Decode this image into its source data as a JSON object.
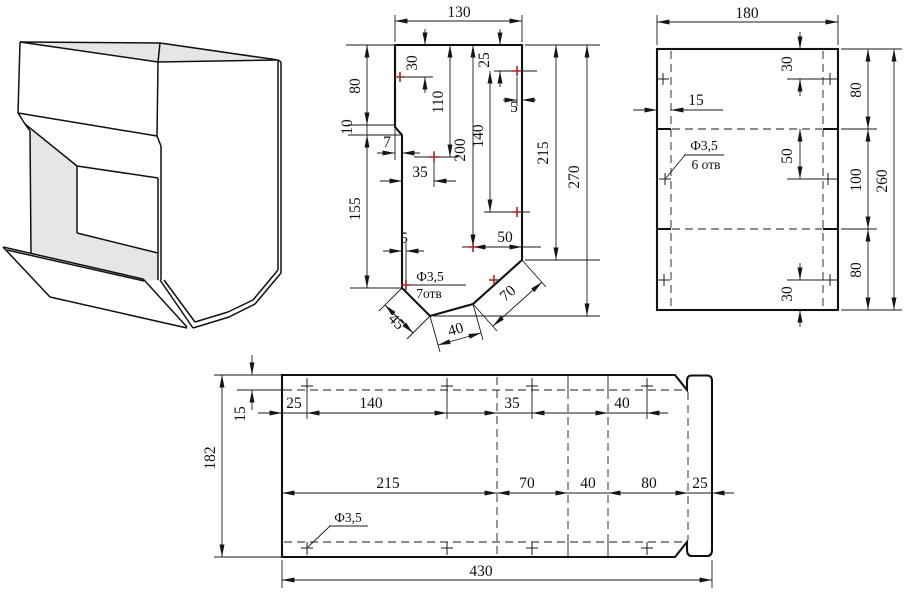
{
  "colors": {
    "line": "#1a1a1a",
    "hole_mark": "#a02424",
    "shade_fill": "#e6e6e6"
  },
  "flat_main": {
    "dims": {
      "overall_width": "130",
      "edge_top": "80",
      "edge_step": "10",
      "edge_lower": "155",
      "step_depth": "7",
      "hole_row1": "30",
      "hole_col": "110",
      "hole_deep": "200",
      "hole_span": "140",
      "hole_row2": "25",
      "edge_off_right": "5",
      "hole_left": "35",
      "edge_off_bottom": "5",
      "hole_bottom": "50",
      "height_right": "215",
      "height_overall": "270",
      "chamfer_left": "45",
      "chamfer_mid": "40",
      "chamfer_right": "70",
      "holes_dia": "Ф3,5",
      "holes_count": "7отв"
    }
  },
  "flat_side": {
    "dims": {
      "overall_width": "180",
      "holes_top": "30",
      "band_top": "80",
      "edge_offset": "15",
      "holes_mid": "50",
      "band_mid": "100",
      "band_bottom": "80",
      "holes_bottom": "30",
      "height_overall": "260",
      "holes_dia": "Ф3,5",
      "holes_count": "6 отв"
    }
  },
  "flat_bottom": {
    "dims": {
      "height": "182",
      "flap_offset": "15",
      "col1": "25",
      "col2": "140",
      "col3": "35",
      "col4": "40",
      "row1": "215",
      "row2": "70",
      "row3": "40",
      "row4": "80",
      "row5": "25",
      "overall_width": "430",
      "holes_dia": "Ф3,5"
    }
  }
}
